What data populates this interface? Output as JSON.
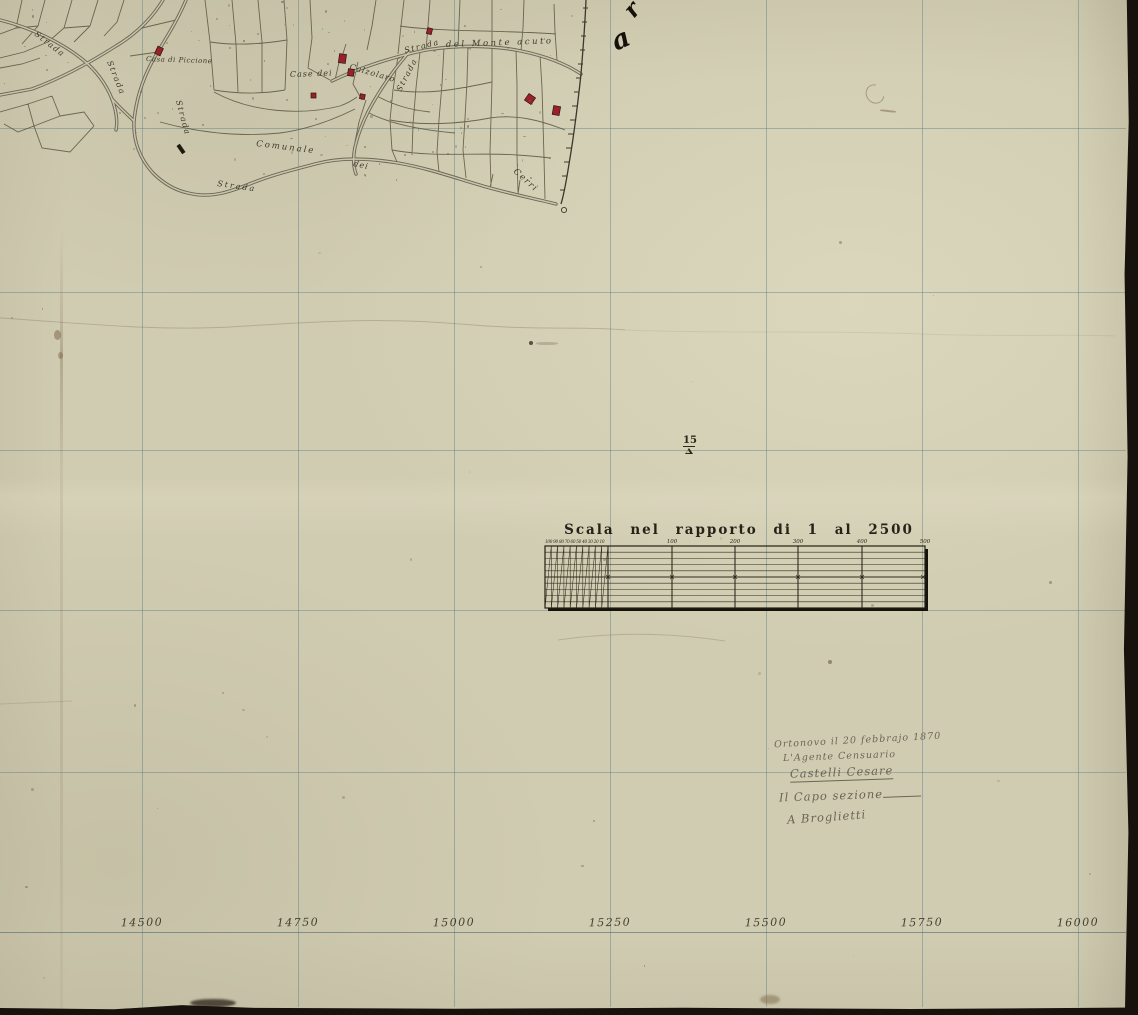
{
  "map": {
    "road_labels": [
      {
        "name": "strada-upper-left",
        "text": "Strada"
      },
      {
        "name": "strada-left-diagonal",
        "text": "Strada"
      },
      {
        "name": "strada-vertical",
        "text": "Strada"
      },
      {
        "name": "strada-branch",
        "text": "Strada"
      },
      {
        "name": "strada-monteacuto-prefix",
        "text": "Strada"
      },
      {
        "name": "del-monte-acuto",
        "text": "del Monte acuto"
      },
      {
        "name": "strada-bottom",
        "text": "Strada"
      },
      {
        "name": "comunale",
        "text": "Comunale"
      },
      {
        "name": "dei",
        "text": "dei"
      },
      {
        "name": "cerri",
        "text": "Cerri"
      }
    ],
    "place_labels": [
      {
        "name": "casa-di-piccione",
        "text": "Casa di Piccione"
      },
      {
        "name": "case-dei",
        "text": "Case dei"
      },
      {
        "name": "calzolaro",
        "text": "Calzolaro"
      }
    ]
  },
  "survey_marker": {
    "label": "15"
  },
  "margin_letters": {
    "top": "r",
    "bottom": "a"
  },
  "scale_bar": {
    "title": "Scala nel rapporto di 1 al 2500",
    "fine_scale_labels": "100 90 80 70 60 50 40 30 20 10",
    "division_labels": [
      "100",
      "200",
      "300",
      "400",
      "500"
    ]
  },
  "signature_block": {
    "place_date": "Ortonovo il 20 febbrajo 1870",
    "role_1": "L'Agente Censuario",
    "signature_1": "Castelli Cesare",
    "role_2": "Il Capo sezione",
    "signature_2": "A Broglietti"
  },
  "bottom_coordinates": [
    "14500",
    "14750",
    "15000",
    "15250",
    "15500",
    "15750",
    "16000"
  ],
  "colors": {
    "paper": "#d0ccb2",
    "grid_line": "#587684",
    "map_line": "#59543f",
    "road": "#6c6858",
    "building_red": "#9b2028",
    "ink": "#272217",
    "handwriting": "#6e6455",
    "scan_edge": "#17120c"
  }
}
